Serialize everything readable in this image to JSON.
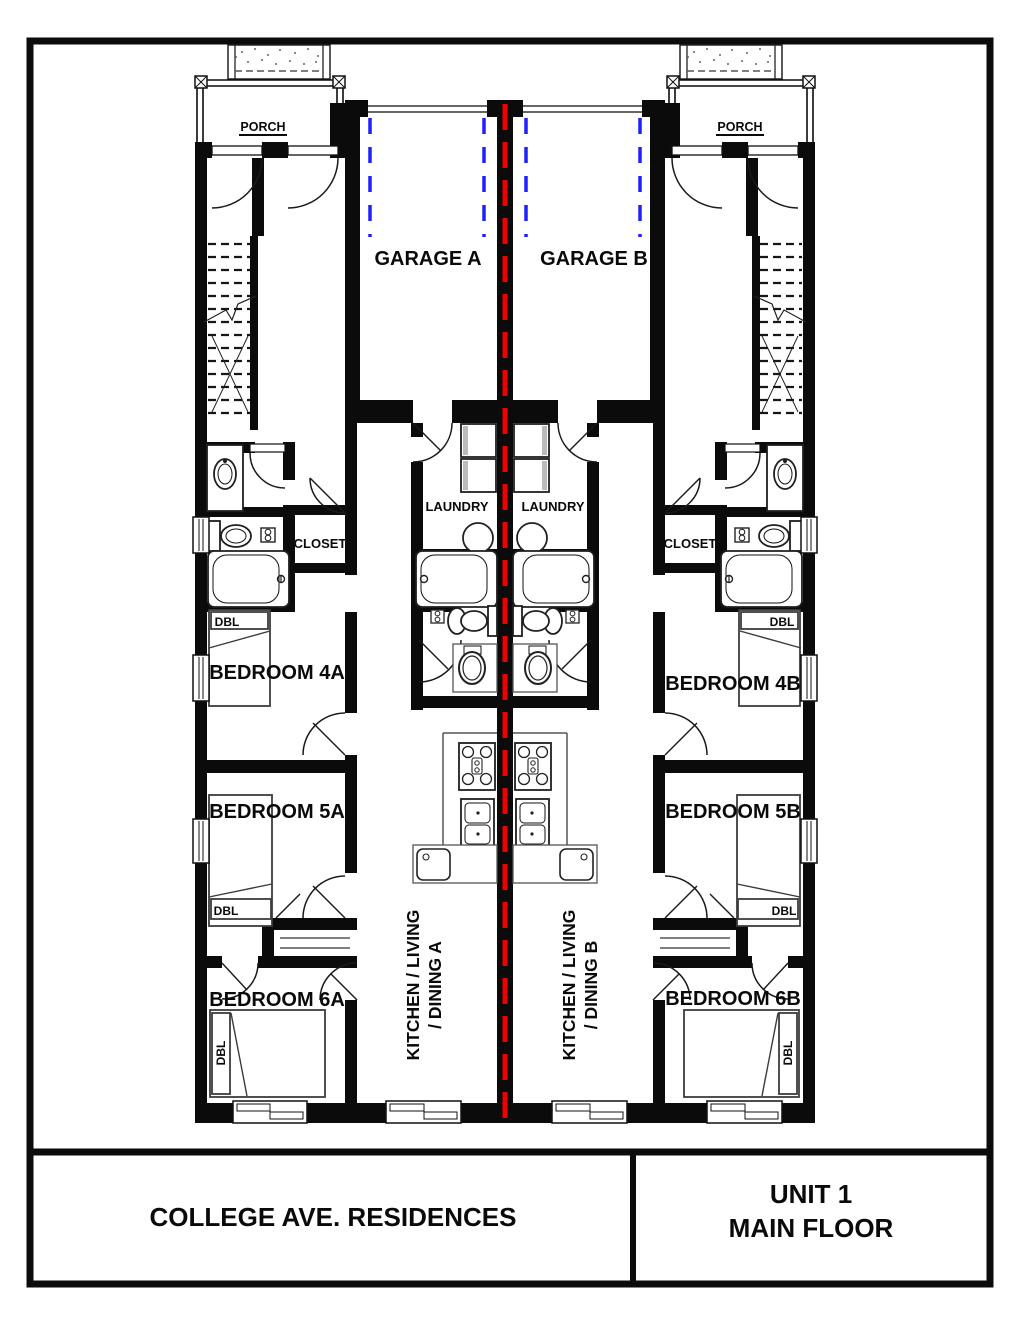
{
  "title_block": {
    "project": "COLLEGE AVE. RESIDENCES",
    "sheet_line1": "UNIT 1",
    "sheet_line2": "MAIN FLOOR"
  },
  "rooms": {
    "porch_left": "PORCH",
    "porch_right": "PORCH",
    "garage_a": "GARAGE A",
    "garage_b": "GARAGE B",
    "laundry_a": "LAUNDRY",
    "laundry_b": "LAUNDRY",
    "closet_a": "CLOSET",
    "closet_b": "CLOSET",
    "bedroom_4a": "BEDROOM 4A",
    "bedroom_5a": "BEDROOM 5A",
    "bedroom_6a": "BEDROOM 6A",
    "bedroom_4b": "BEDROOM 4B",
    "bedroom_5b": "BEDROOM 5B",
    "bedroom_6b": "BEDROOM 6B",
    "kitchen_a": {
      "line1": "KITCHEN / LIVING",
      "line2": "/ DINING A"
    },
    "kitchen_b": {
      "line1": "KITCHEN / LIVING",
      "line2": "/ DINING B"
    }
  },
  "furniture": {
    "double_bed_tag": "DBL"
  },
  "colors": {
    "wall": "#0b0b0b",
    "demising_line": "#ee0000",
    "garage_clearance": "#1f1fff",
    "paper": "#ffffff"
  }
}
